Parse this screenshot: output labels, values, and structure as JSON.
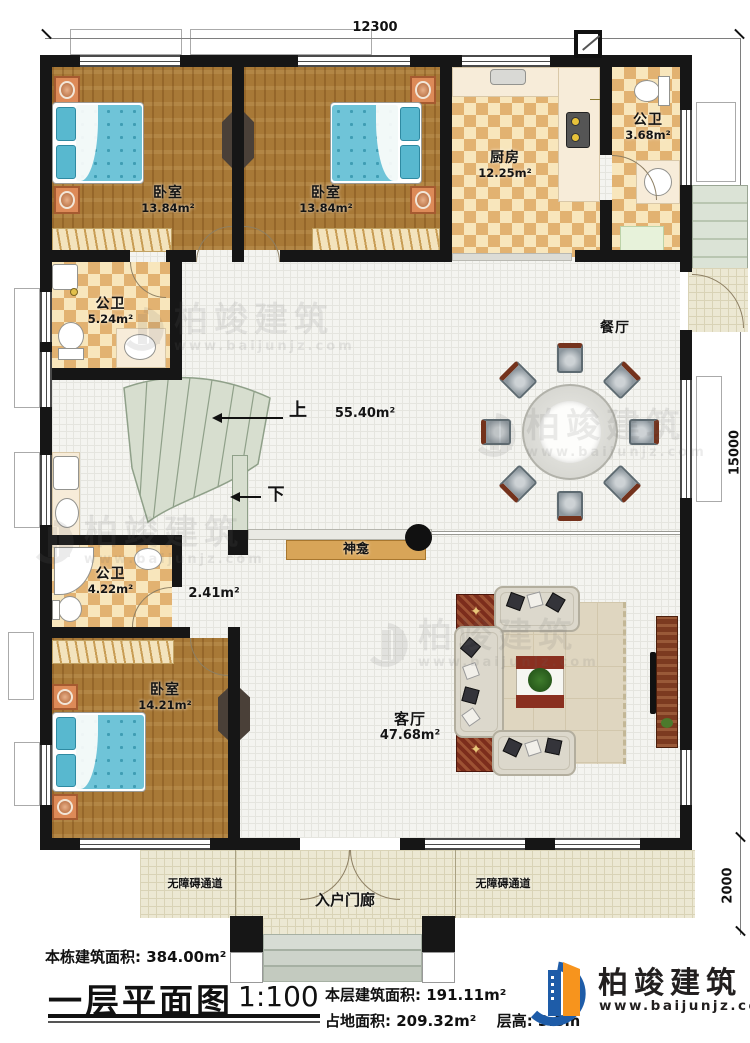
{
  "dimensions": {
    "top": "12300",
    "right": "15000",
    "bottom_right": "2000"
  },
  "rooms": {
    "bedroom1": {
      "name": "卧室",
      "area": "13.84m²"
    },
    "bedroom2": {
      "name": "卧室",
      "area": "13.84m²"
    },
    "bedroom3": {
      "name": "卧室",
      "area": "14.21m²"
    },
    "kitchen": {
      "name": "厨房",
      "area": "12.25m²"
    },
    "bath_top": {
      "name": "公卫",
      "area": "3.68m²"
    },
    "bath_mid": {
      "name": "公卫",
      "area": "5.24m²"
    },
    "bath_low": {
      "name": "公卫",
      "area": "4.22m²"
    },
    "hall": {
      "area": "55.40m²"
    },
    "corridor": {
      "area": "2.41m²"
    },
    "dining": {
      "name": "餐厅"
    },
    "living": {
      "name": "客厅",
      "area": "47.68m²"
    }
  },
  "annotations": {
    "up": "上",
    "down": "下",
    "shrine": "神龛",
    "porch": "入户门廊",
    "ramp_left": "无障碍通道",
    "ramp_right": "无障碍通道"
  },
  "footer": {
    "building_area_label": "本栋建筑面积:",
    "building_area_value": "384.00m²",
    "plan_title": "一层平面图",
    "scale": "1:100",
    "floor_area_label": "本层建筑面积:",
    "floor_area_value": "191.11m²",
    "site_area_label": "占地面积:",
    "site_area_value": "209.32m²",
    "floor_height_label": "层高:",
    "floor_height_value": "3.8m"
  },
  "brand": {
    "name": "柏竣建筑",
    "url": "www.baijunjz.com"
  },
  "watermark": {
    "name": "柏竣建筑",
    "url": "www.baijunjz.com"
  },
  "colors": {
    "wall": "#161616",
    "wood_floor": "#a87937",
    "tile_dark": "#e2b271",
    "tile_light": "#f8e6bc",
    "stair_green": "#d7decf",
    "bed_teal": "#6fc4d8",
    "logo_blue": "#1e5ca8",
    "logo_orange": "#f7941d"
  }
}
